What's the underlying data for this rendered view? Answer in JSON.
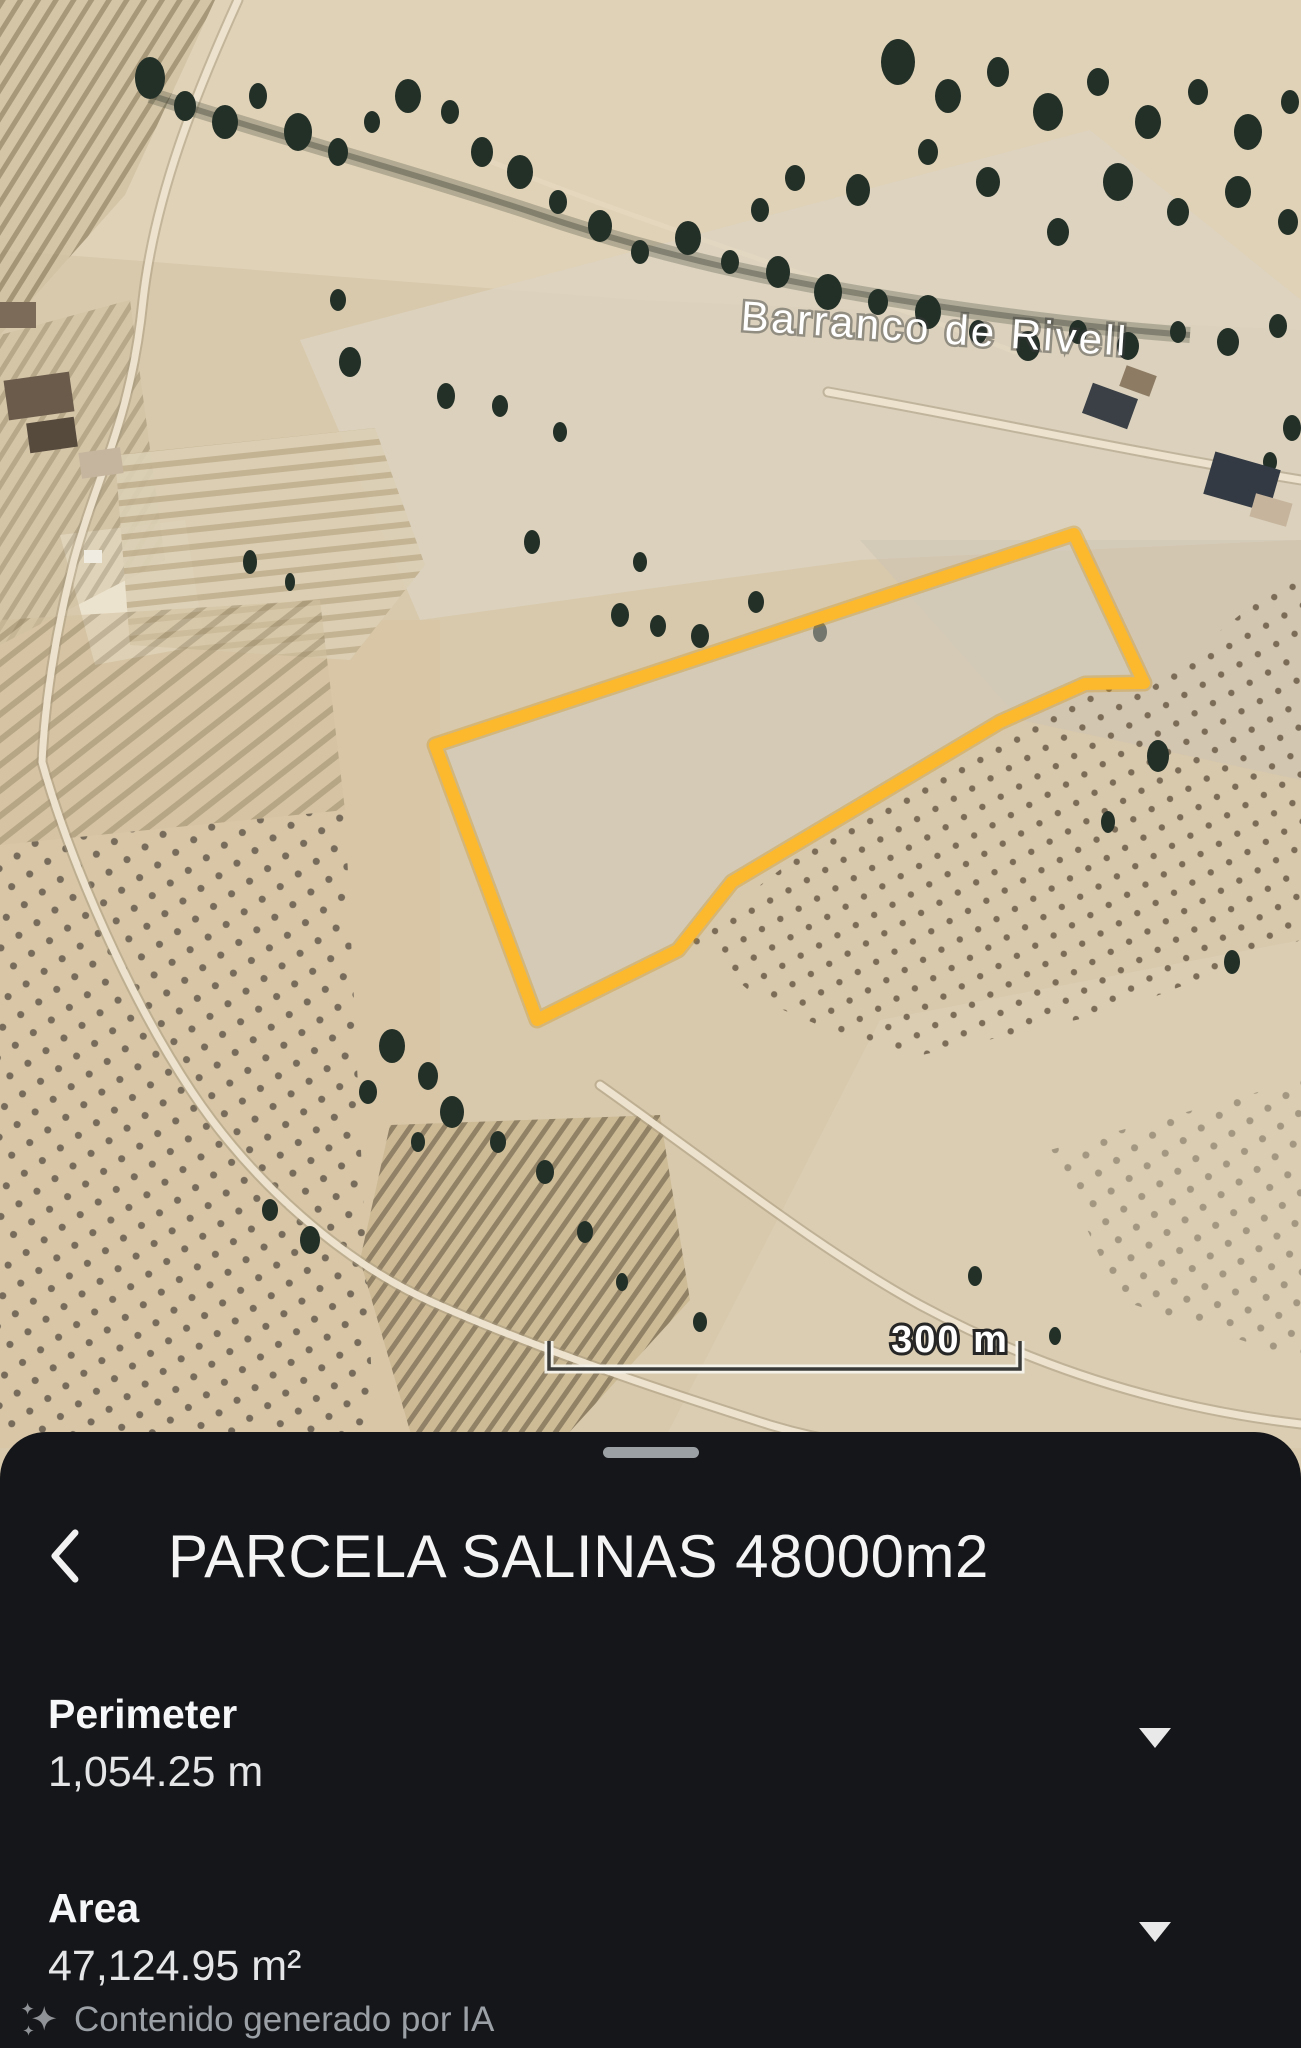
{
  "colors": {
    "parcel_outline": "#FDB92E",
    "sheet_background": "#151619",
    "muted_text": "#9AA0A6"
  },
  "map": {
    "place_label": "Barranco de Rivell",
    "scale_label": "300 m"
  },
  "sheet": {
    "title": "PARCELA SALINAS 48000m2",
    "metrics": [
      {
        "label": "Perimeter",
        "value": "1,054.25 m"
      },
      {
        "label": "Area",
        "value": "47,124.95 m²"
      }
    ],
    "ai_notice": "Contenido generado por IA"
  }
}
